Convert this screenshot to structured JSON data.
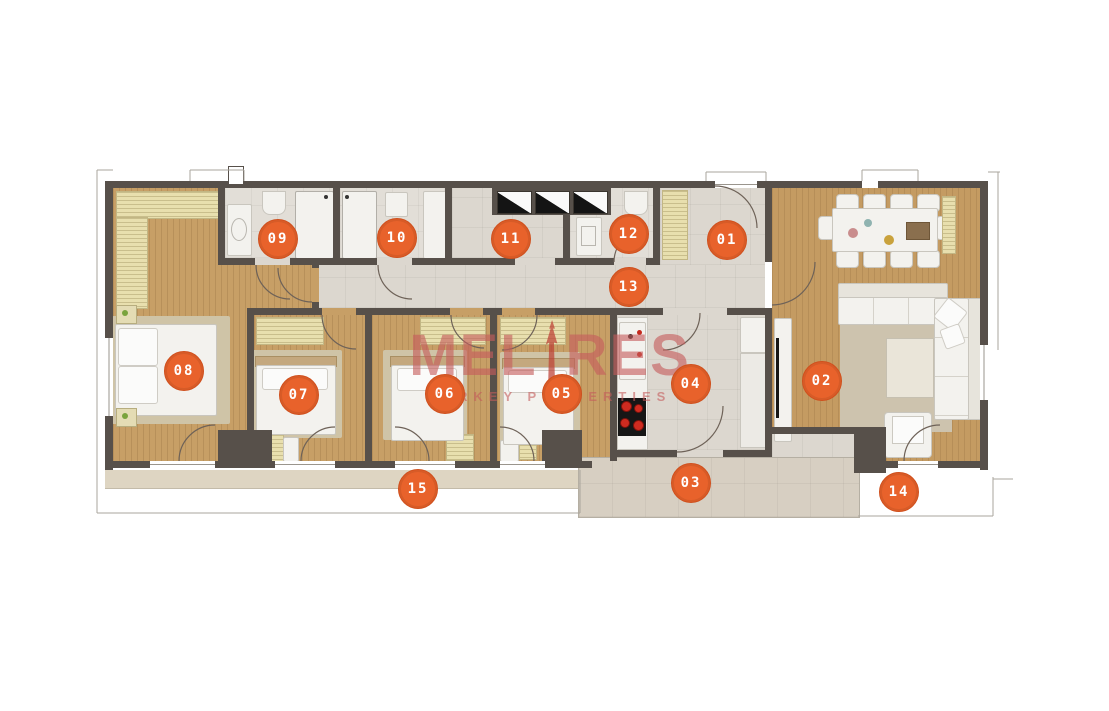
{
  "watermark": {
    "brand_prefix": "MEL",
    "brand_suffix": "RES",
    "tagline": "TURKEY PROPERTIES"
  },
  "markers": [
    {
      "label": "01",
      "room": "entrance-hall",
      "x": 727,
      "y": 240
    },
    {
      "label": "02",
      "room": "living-room",
      "x": 822,
      "y": 381
    },
    {
      "label": "03",
      "room": "terrace",
      "x": 691,
      "y": 483
    },
    {
      "label": "04",
      "room": "kitchen",
      "x": 691,
      "y": 384
    },
    {
      "label": "05",
      "room": "bedroom",
      "x": 562,
      "y": 394
    },
    {
      "label": "06",
      "room": "bedroom",
      "x": 445,
      "y": 394
    },
    {
      "label": "07",
      "room": "bedroom",
      "x": 299,
      "y": 395
    },
    {
      "label": "08",
      "room": "master-bedroom",
      "x": 184,
      "y": 371
    },
    {
      "label": "09",
      "room": "bathroom",
      "x": 278,
      "y": 239
    },
    {
      "label": "10",
      "room": "bathroom",
      "x": 397,
      "y": 238
    },
    {
      "label": "11",
      "room": "utility-room",
      "x": 511,
      "y": 239
    },
    {
      "label": "12",
      "room": "wc",
      "x": 629,
      "y": 234
    },
    {
      "label": "13",
      "room": "hallway",
      "x": 629,
      "y": 287
    },
    {
      "label": "14",
      "room": "balcony",
      "x": 899,
      "y": 492
    },
    {
      "label": "15",
      "room": "balcony",
      "x": 418,
      "y": 489
    }
  ],
  "colors": {
    "marker_orange": "#e8622b",
    "wall": "#57504a",
    "wood_floor": "#c79f66",
    "tile_floor": "#dcd7cf",
    "terrace_tile": "#d7cfc2",
    "closet_beige": "#e8dfae",
    "watermark_red": "#c55c5c"
  }
}
